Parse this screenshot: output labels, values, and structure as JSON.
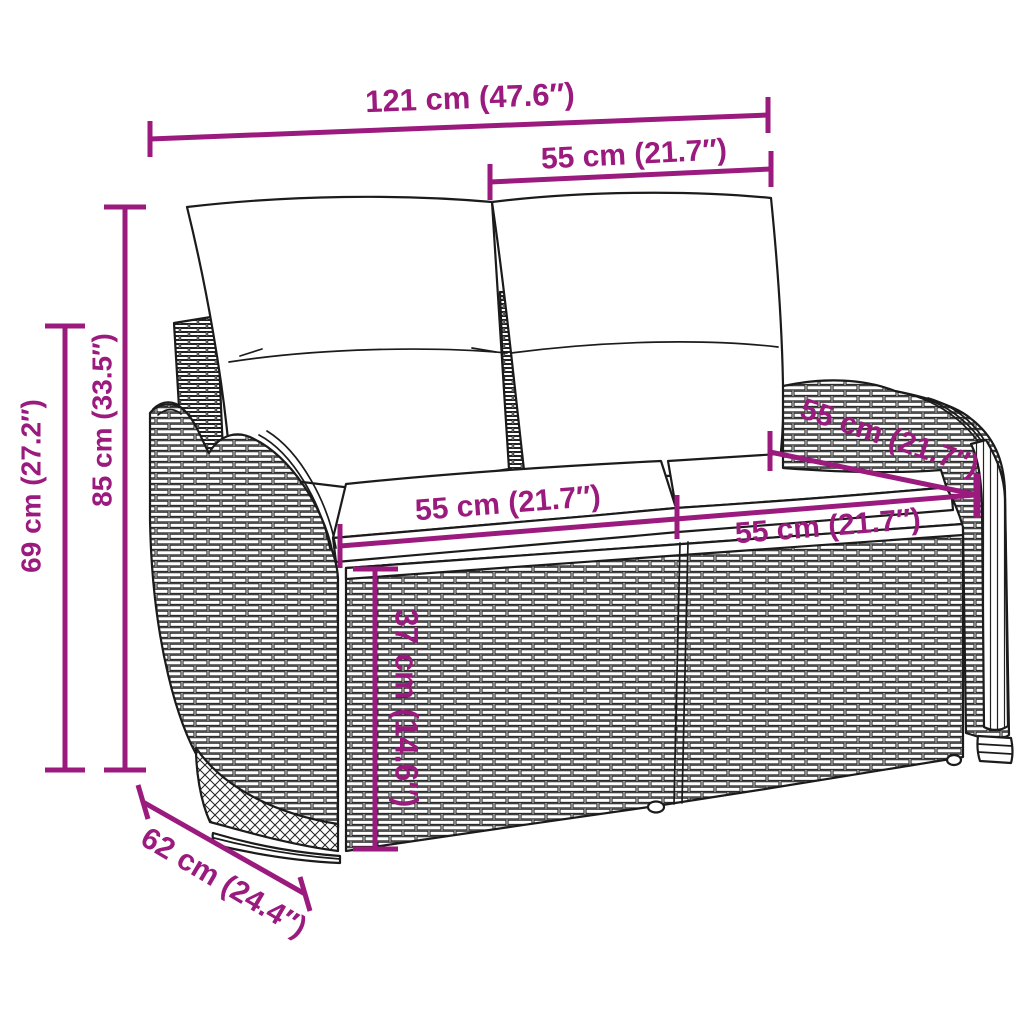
{
  "figure": {
    "alt": "Line drawing of a two-seater poly rattan garden bench with back and seat cushions, annotated with dimensions"
  },
  "dimensions": {
    "overall_width": "121 cm (47.6″)",
    "backrest_width": "55 cm (21.7″)",
    "back_height": "85 cm (33.5″)",
    "arm_height": "69 cm (27.2″)",
    "seat_width_left": "55 cm (21.7″)",
    "seat_width_right": "55 cm (21.7″)",
    "armrest_depth": "55 cm (21.7″)",
    "seat_height": "37 cm (14.6″)",
    "overall_depth": "62 cm (24.4″)"
  },
  "colors": {
    "dimension_accent": "#9B1A7E",
    "line_art": "#1B1B1B",
    "background": "#FFFFFF"
  }
}
